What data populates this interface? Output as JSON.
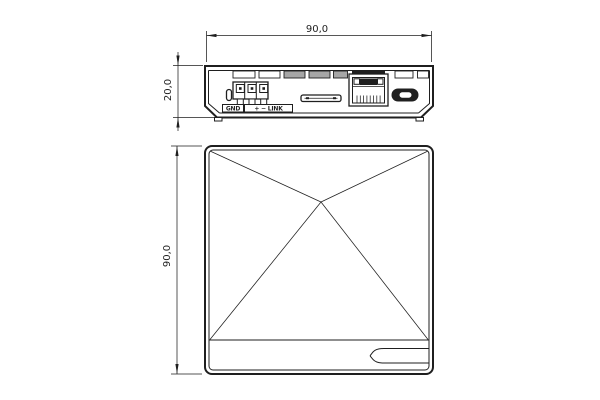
{
  "drawing_type": "mechanical-dimension-drawing",
  "colors": {
    "background": "#ffffff",
    "line": "#1f1f1f",
    "vent_shaded": "#a6a6a6"
  },
  "rear_view": {
    "width_dim": "90,0",
    "height_dim": "20,0",
    "labels": {
      "ground": "GND",
      "signal": "+ − LINK"
    },
    "ports": [
      "oval-slot",
      "terminal-block-3pin",
      "card-slot",
      "rj45-ethernet-port",
      "micro-usb-port"
    ],
    "vent_slot_count": 7
  },
  "front_view": {
    "height_dim": "90,0",
    "features": [
      "pyramid-fold-lines",
      "bottom-band",
      "side-tag-slot"
    ]
  }
}
